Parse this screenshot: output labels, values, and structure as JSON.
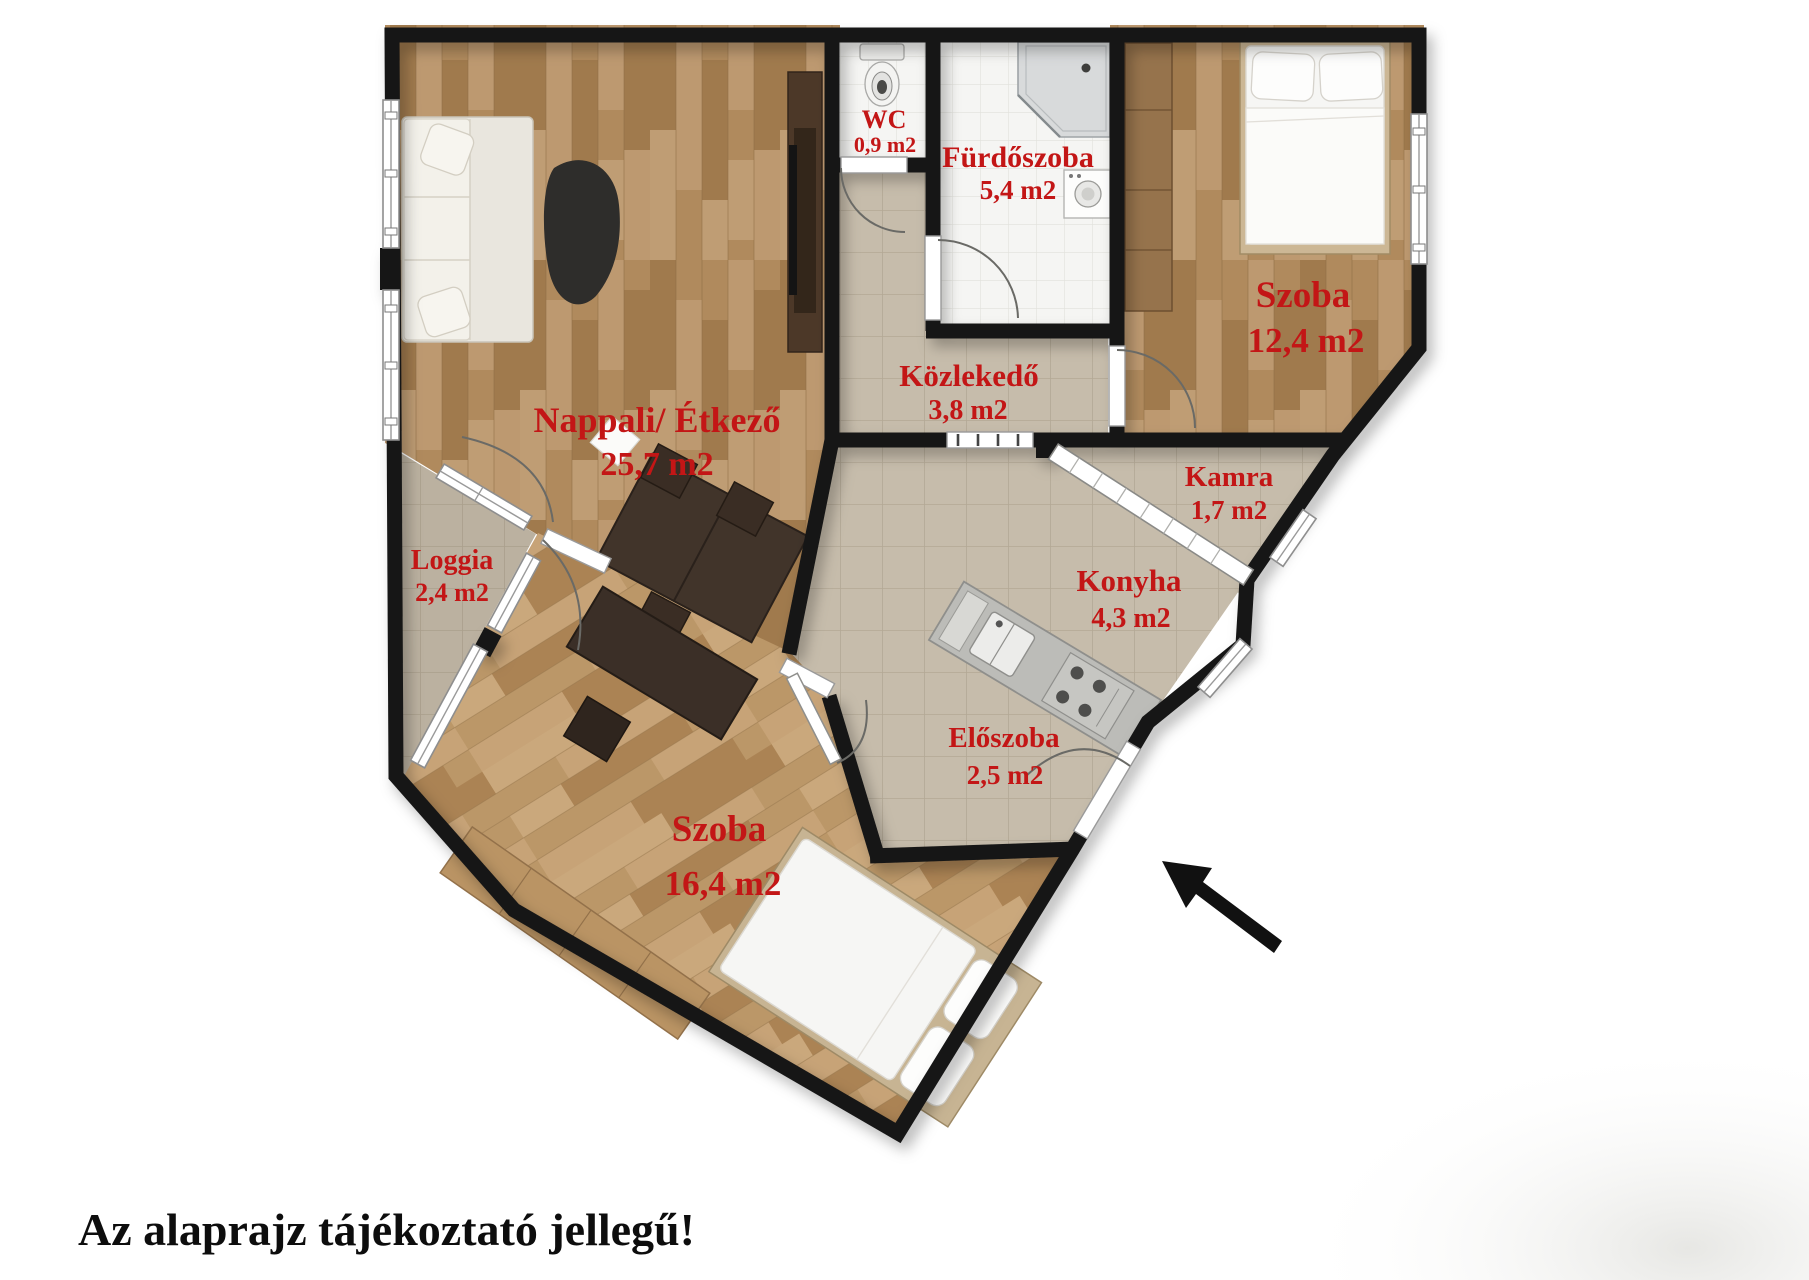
{
  "disclaimer": "Az alaprajz tájékoztató jellegű!",
  "colors": {
    "label_red": "#c31616",
    "wall_black": "#161616",
    "wood_floor": "#b08a5d",
    "tile_floor": "#c6bcab",
    "bath_floor": "#f5f5f3"
  },
  "rooms": {
    "nappali": {
      "name": "Nappali/ Étkező",
      "area": "25,7 m2"
    },
    "wc": {
      "name": "WC",
      "area": "0,9 m2"
    },
    "furdoszoba": {
      "name": "Fürdőszoba",
      "area": "5,4 m2"
    },
    "szoba_felso": {
      "name": "Szoba",
      "area": "12,4 m2"
    },
    "kozlekedo": {
      "name": "Közlekedő",
      "area": "3,8 m2"
    },
    "kamra": {
      "name": "Kamra",
      "area": "1,7 m2"
    },
    "konyha": {
      "name": "Konyha",
      "area": "4,3 m2"
    },
    "eloszoba": {
      "name": "Előszoba",
      "area": "2,5 m2"
    },
    "loggia": {
      "name": "Loggia",
      "area": "2,4 m2"
    },
    "szoba_also": {
      "name": "Szoba",
      "area": "16,4 m2"
    }
  }
}
